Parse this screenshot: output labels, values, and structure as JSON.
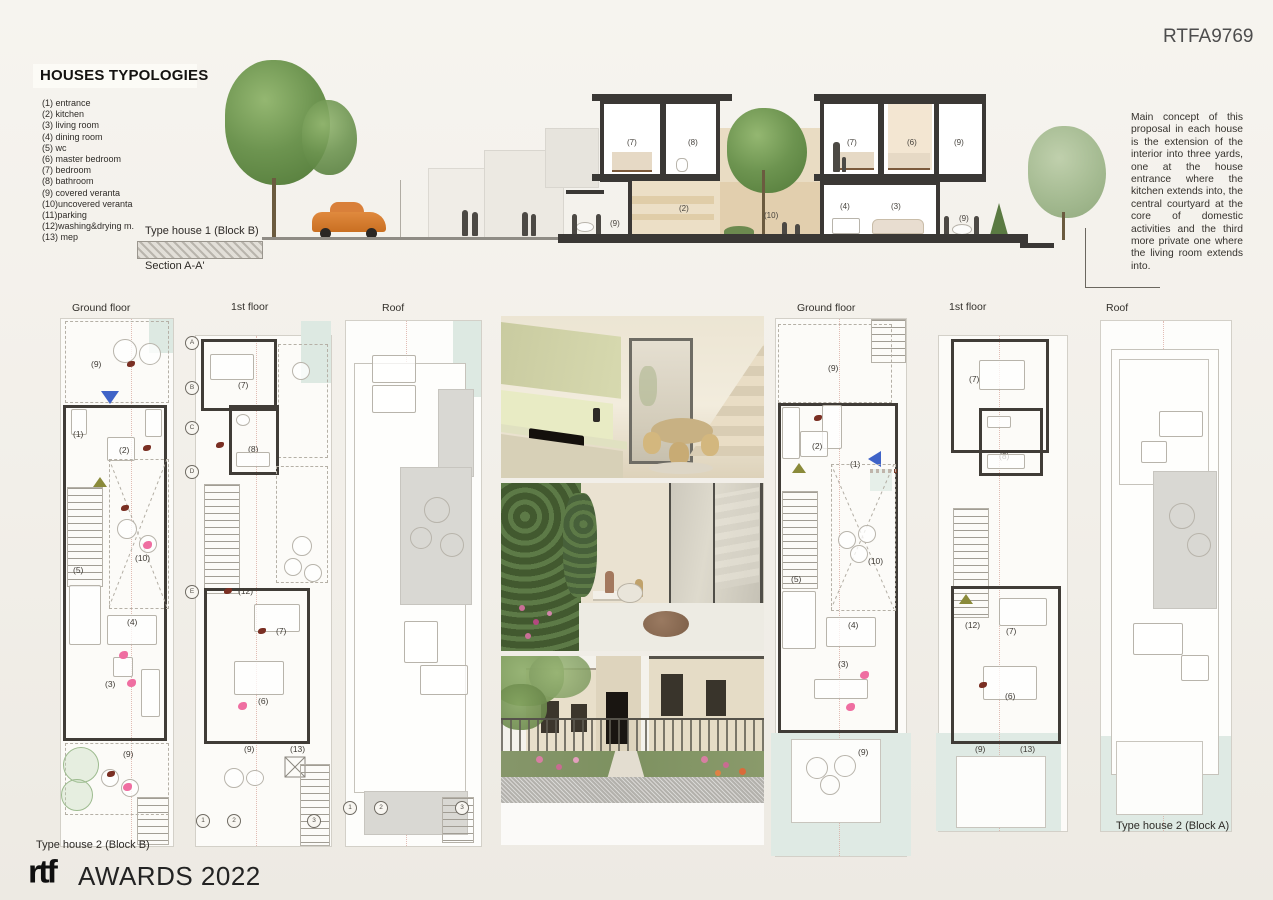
{
  "page": {
    "code": "RTFA9769",
    "title": "HOUSES TYPOLOGIES"
  },
  "legend": {
    "items": [
      "(1) entrance",
      "(2) kitchen",
      "(3) living room",
      "(4) dining room",
      "(5) wc",
      "(6) master bedroom",
      "(7) bedroom",
      "(8) bathroom",
      "(9) covered veranta",
      "(10)uncovered veranta",
      "(11)parking",
      "(12)washing&drying m.",
      "(13) mep"
    ]
  },
  "section": {
    "house_label": "Type house 1 (Block B)",
    "section_label": "Section A-A'",
    "rooms": {
      "left_bed": "(7)",
      "left_bath": "(8)",
      "left_kitchen": "(2)",
      "left_veranda": "(9)",
      "courtyard": "(10)",
      "right_bed": "(7)",
      "right_master": "(6)",
      "right_veranda_up": "(9)",
      "right_dining": "(4)",
      "right_living": "(3)",
      "right_veranda": "(9)"
    }
  },
  "description": {
    "text": "Main concept of this proposal in each house is the extension of the interior into three yards, one at the house entrance where the kitchen extends into, the central courtyard at the core of domestic activities and the third more private one where the living room extends into."
  },
  "plans": {
    "left": {
      "type_label": "Type house 2 (Block B)",
      "ground": {
        "label": "Ground floor",
        "rooms": {
          "veranda_top": "(9)",
          "entrance": "(1)",
          "kitchen": "(2)",
          "wc": "(5)",
          "courtyard": "(10)",
          "dining": "(4)",
          "living": "(3)",
          "veranda_bottom": "(9)"
        }
      },
      "first": {
        "label": "1st floor",
        "rooms": {
          "bedroom_top": "(7)",
          "bathroom": "(8)",
          "laundry": "(12)",
          "bedroom": "(7)",
          "master": "(6)",
          "veranda": "(9)",
          "mep": "(13)"
        }
      },
      "roof": {
        "label": "Roof"
      },
      "grid_letters": [
        "A",
        "B",
        "C",
        "D",
        "E"
      ],
      "grid_numbers": [
        "1",
        "2",
        "3"
      ]
    },
    "right": {
      "type_label": "Type house 2 (Block A)",
      "ground": {
        "label": "Ground floor",
        "rooms": {
          "veranda_top": "(9)",
          "kitchen": "(2)",
          "entrance": "(1)",
          "wc": "(5)",
          "courtyard": "(10)",
          "dining": "(4)",
          "living": "(3)",
          "veranda_bottom": "(9)"
        }
      },
      "first": {
        "label": "1st floor",
        "rooms": {
          "bedroom_top": "(7)",
          "bathroom": "(8)",
          "laundry": "(12)",
          "bedroom": "(7)",
          "master": "(6)",
          "veranda": "(9)",
          "mep": "(13)"
        }
      },
      "roof": {
        "label": "Roof"
      }
    }
  },
  "photos": {
    "items": [
      "kitchen-interior-render",
      "courtyard-render",
      "street-entrance-render"
    ]
  },
  "footer": {
    "brand": "rtf",
    "text": "AWARDS 2022"
  }
}
